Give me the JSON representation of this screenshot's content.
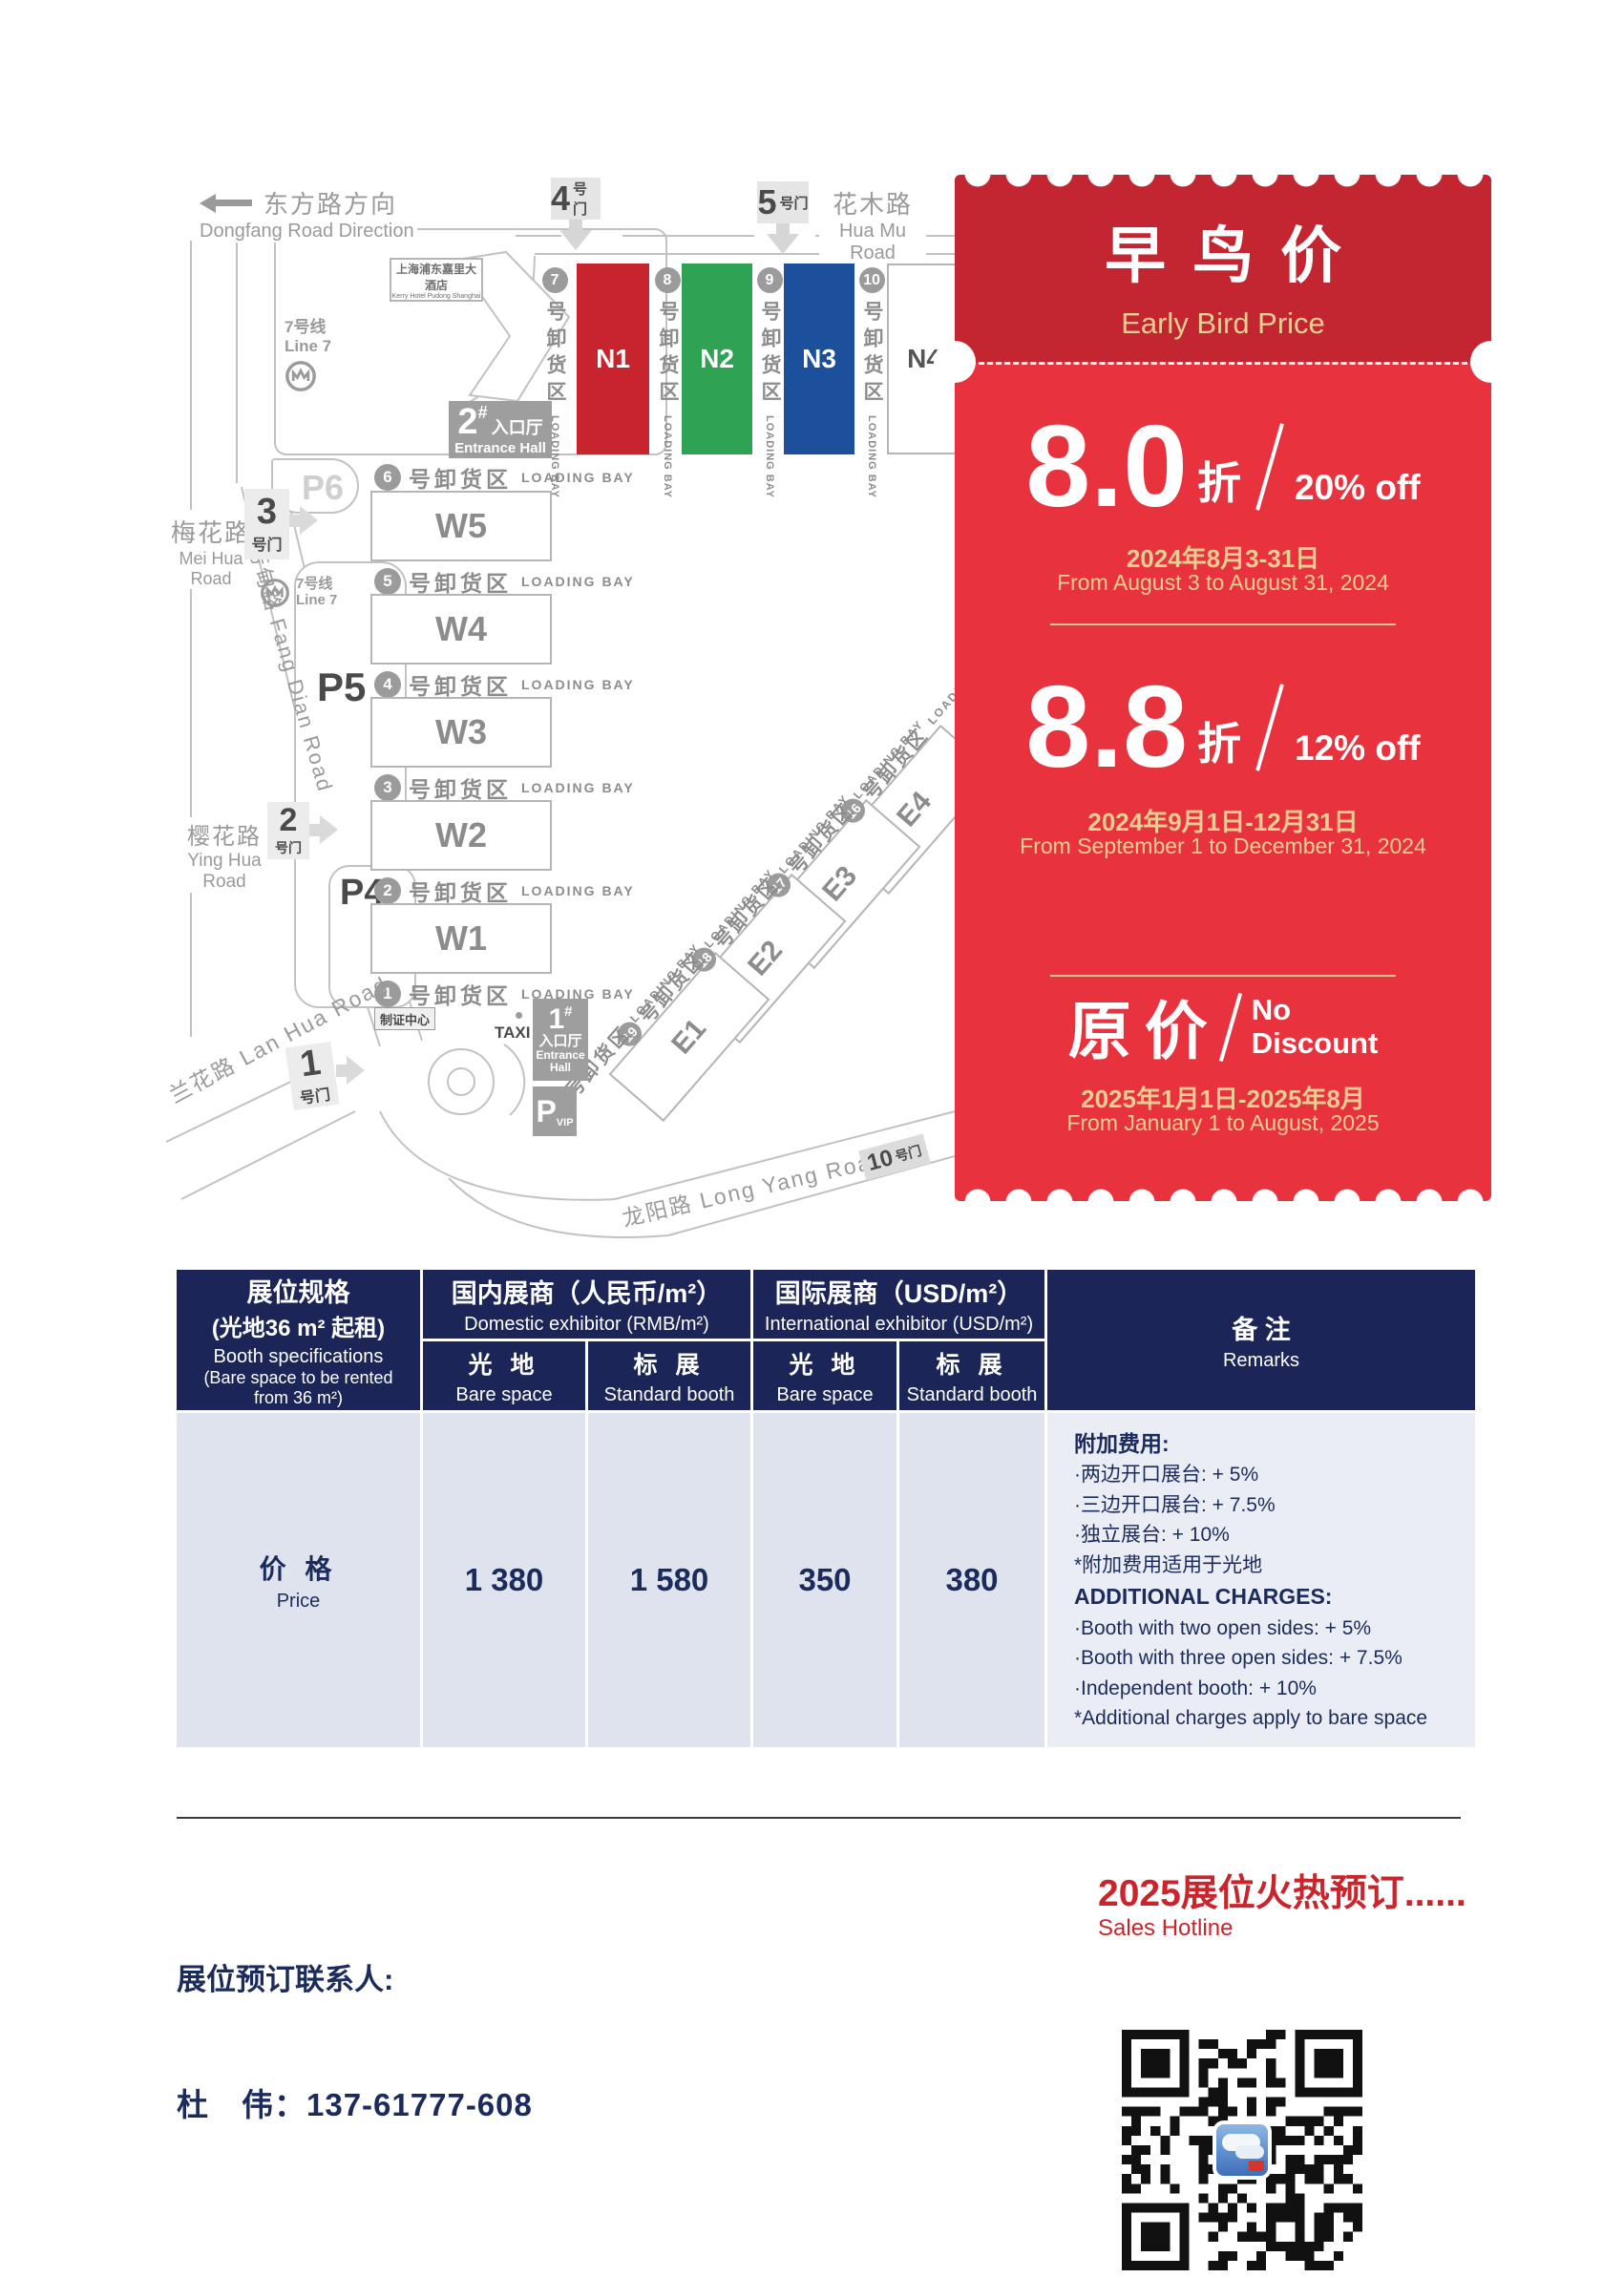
{
  "map": {
    "roads": {
      "dongfang_cn": "东方路方向",
      "dongfang_en": "Dongfang Road Direction",
      "huamu_cn": "花木路",
      "huamu_en": "Hua Mu Road",
      "meihua_cn": "梅花路",
      "meihua_en": "Mei Hua Road",
      "fangdian": "芳甸路 Fang Dian Road",
      "yinghua_cn": "樱花路",
      "yinghua_en": "Ying Hua Road",
      "lanhua": "兰花路 Lan Hua Road",
      "longyang": "龙阳路 Long Yang Road"
    },
    "line7_cn": "7号线",
    "line7_en": "Line 7",
    "hotel_cn": "上海浦东嘉里大酒店",
    "hotel_en": "Kerry Hotel Pudong Shanghai",
    "gate_suffix": "号门",
    "gates": {
      "g4": "4",
      "g5": "5",
      "g3": "3",
      "g2": "2",
      "g1": "1",
      "g10": "10"
    },
    "entrance_hash": "#",
    "entrance2_num": "2",
    "entrance1_num": "1",
    "entrance_cn": "入口厅",
    "entrance_en": "Entrance Hall",
    "entrance1_en1": "Entrance",
    "entrance1_en2": "Hall",
    "loading_cn": "号卸货区",
    "loading_en": "LOADING BAY",
    "bays_n": [
      "7",
      "8",
      "9",
      "10"
    ],
    "bays_w": [
      "6",
      "5",
      "4",
      "3",
      "2",
      "1"
    ],
    "bays_e": [
      "16",
      "17",
      "18",
      "19",
      "20"
    ],
    "halls_n": [
      "N1",
      "N2",
      "N3",
      "N4"
    ],
    "halls_w": [
      "W5",
      "W4",
      "W3",
      "W2",
      "W1"
    ],
    "halls_e": [
      "E4",
      "E3",
      "E2",
      "E1"
    ],
    "hall_colors": {
      "n1": "#c8242e",
      "n2": "#2fa254",
      "n3": "#1c4f9c"
    },
    "parking": {
      "p6": "P6",
      "p5": "P5",
      "p4": "P4",
      "pvip": "P",
      "pvip_sub": "VIP"
    },
    "taxi": "TAXI",
    "cert_center": "制证中心"
  },
  "ticket": {
    "title_cn": "早鸟价",
    "title_en": "Early Bird Price",
    "tier1": {
      "rate": "8.0",
      "unit": "折",
      "off": "20% off",
      "date_cn": "2024年8月3-31日",
      "date_en": "From August 3 to August 31, 2024"
    },
    "tier2": {
      "rate": "8.8",
      "unit": "折",
      "off": "12% off",
      "date_cn": "2024年9月1日-12月31日",
      "date_en": "From September 1 to December 31, 2024"
    },
    "tier3": {
      "rate": "原价",
      "off1": "No",
      "off2": "Discount",
      "date_cn": "2025年1月1日-2025年8月",
      "date_en": "From January 1 to August, 2025"
    }
  },
  "table": {
    "spec": {
      "cn1": "展位规格",
      "cn2": "(光地36 m² 起租)",
      "en1": "Booth specifications",
      "en2": "(Bare space to be rented",
      "en3": "from 36 m²)"
    },
    "domestic": {
      "cn": "国内展商（人民币/m²）",
      "en": "Domestic exhibitor (RMB/m²)"
    },
    "international": {
      "cn": "国际展商（USD/m²）",
      "en": "International exhibitor (USD/m²)"
    },
    "remarks_hdr": {
      "cn": "备 注",
      "en": "Remarks"
    },
    "sub": {
      "bare_cn": "光 地",
      "bare_en": "Bare space",
      "std_cn": "标 展",
      "std_en": "Standard booth"
    },
    "price": {
      "cn": "价 格",
      "en": "Price",
      "v1": "1 380",
      "v2": "1 580",
      "v3": "350",
      "v4": "380"
    },
    "remarks": {
      "cn_title": "附加费用:",
      "cn1": "·两边开口展台: + 5%",
      "cn2": "·三边开口展台: + 7.5%",
      "cn3": "·独立展台: + 10%",
      "cn4": "*附加费用适用于光地",
      "en_title": "ADDITIONAL CHARGES:",
      "en1": "·Booth with two open sides: + 5%",
      "en2": "·Booth with three open sides: + 7.5%",
      "en3": "·Independent booth: + 10%",
      "en4": "*Additional charges apply to bare space"
    }
  },
  "footer": {
    "hotline_cn": "2025展位火热预订......",
    "hotline_en": "Sales Hotline",
    "contact_label": "展位预订联系人:",
    "contact": "杜　伟：137-61777-608"
  }
}
